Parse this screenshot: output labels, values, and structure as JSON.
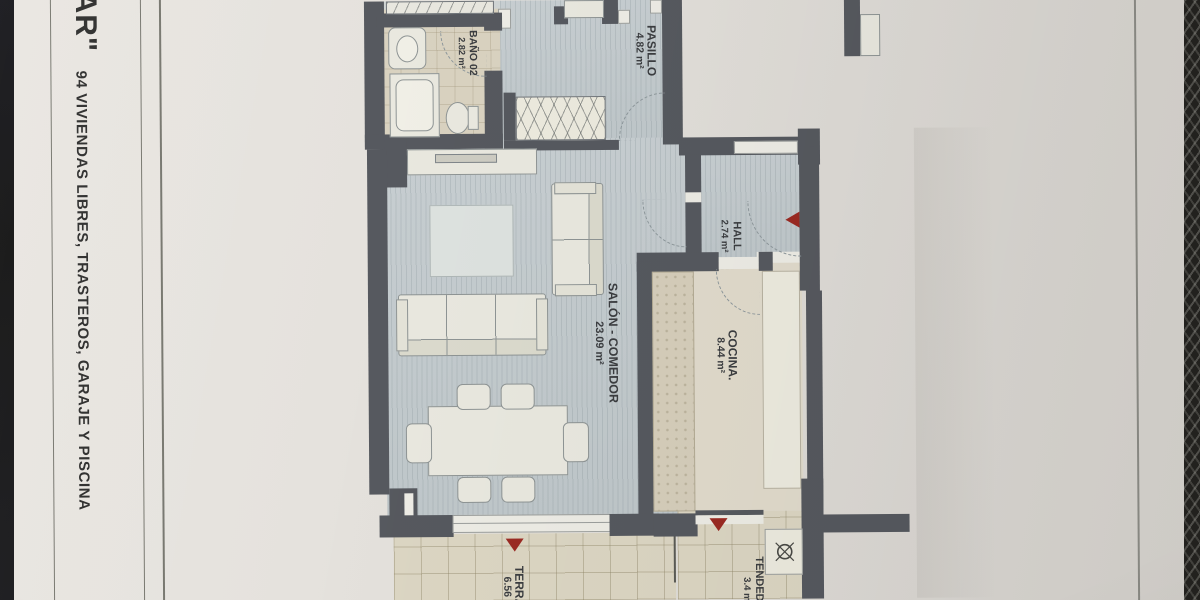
{
  "sheet": {
    "side_title_fragment": "AR\"",
    "side_subtitle": "94 VIVIENDAS LIBRES, TRASTEROS, GARAJE Y PISCINA"
  },
  "rooms": [
    {
      "name": "BAÑO 02",
      "area": "2.82 m²"
    },
    {
      "name": "PASILLO",
      "area": "4.82 m²"
    },
    {
      "name": "HALL",
      "area": "2.74 m²"
    },
    {
      "name": "SALÓN - COMEDOR",
      "area": "23.09 m²"
    },
    {
      "name": "COCINA.",
      "area": "8.44 m²"
    },
    {
      "name": "TERRAZA",
      "area": "6.56 m²"
    },
    {
      "name": "TENDEDERO",
      "area": "3.4 m²"
    }
  ],
  "markers": {
    "entrance_arrow_count": 3,
    "drain_symbol": "circle-cross"
  },
  "colors": {
    "wall": "#56595f",
    "interior_floor": "#c4cbce",
    "wet_floor": "#d9d2c0",
    "terrace_tile": "#dcd6c3",
    "accent_red": "#9b2a23",
    "paper": "#e3e0da"
  }
}
